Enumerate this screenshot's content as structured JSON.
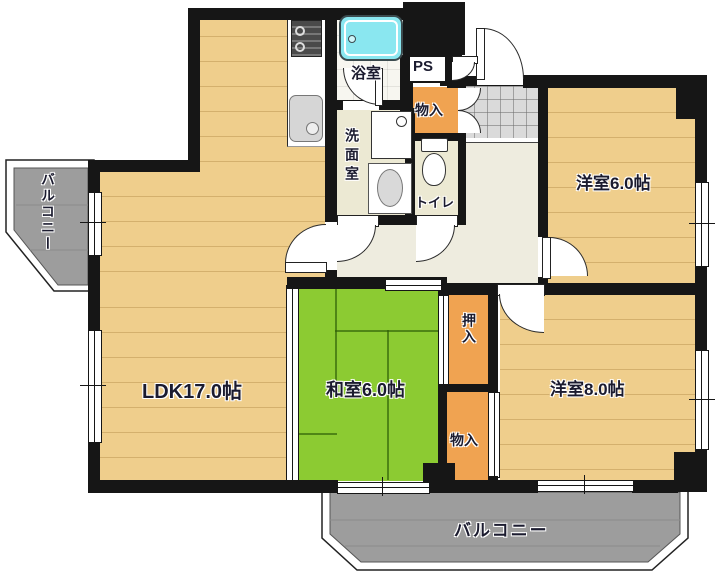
{
  "plan": {
    "type": "apartment-floor-plan",
    "rooms": {
      "ldk": "LDK17.0帖",
      "washitsu": "和室6.0帖",
      "bedroom6": "洋室6.0帖",
      "bedroom8": "洋室8.0帖",
      "bathroom": "浴室",
      "washroom": "洗面室",
      "toilet": "トイレ",
      "pipe_space": "PS",
      "entry_closet": "物入",
      "oshiire": "押入",
      "south_closet": "物入",
      "balcony_left": "バルコニー",
      "balcony_south": "バルコニー"
    },
    "colors": {
      "wall": "#161616",
      "wood_floor": "#efce8c",
      "tatami": "#8ccb32",
      "closet": "#f0a351",
      "service_floor": "#ece9d3",
      "hall_floor": "#eeecdf",
      "genkan_tile": "#dadada",
      "balcony": "#9d9d9d",
      "bathtub": "#8ae7f0",
      "label_text": "#1b1b2f"
    },
    "icons": [
      "stove-icon",
      "sink-icon",
      "bathtub-icon",
      "vanity-icon",
      "washing-machine-icon",
      "toilet-icon"
    ]
  }
}
